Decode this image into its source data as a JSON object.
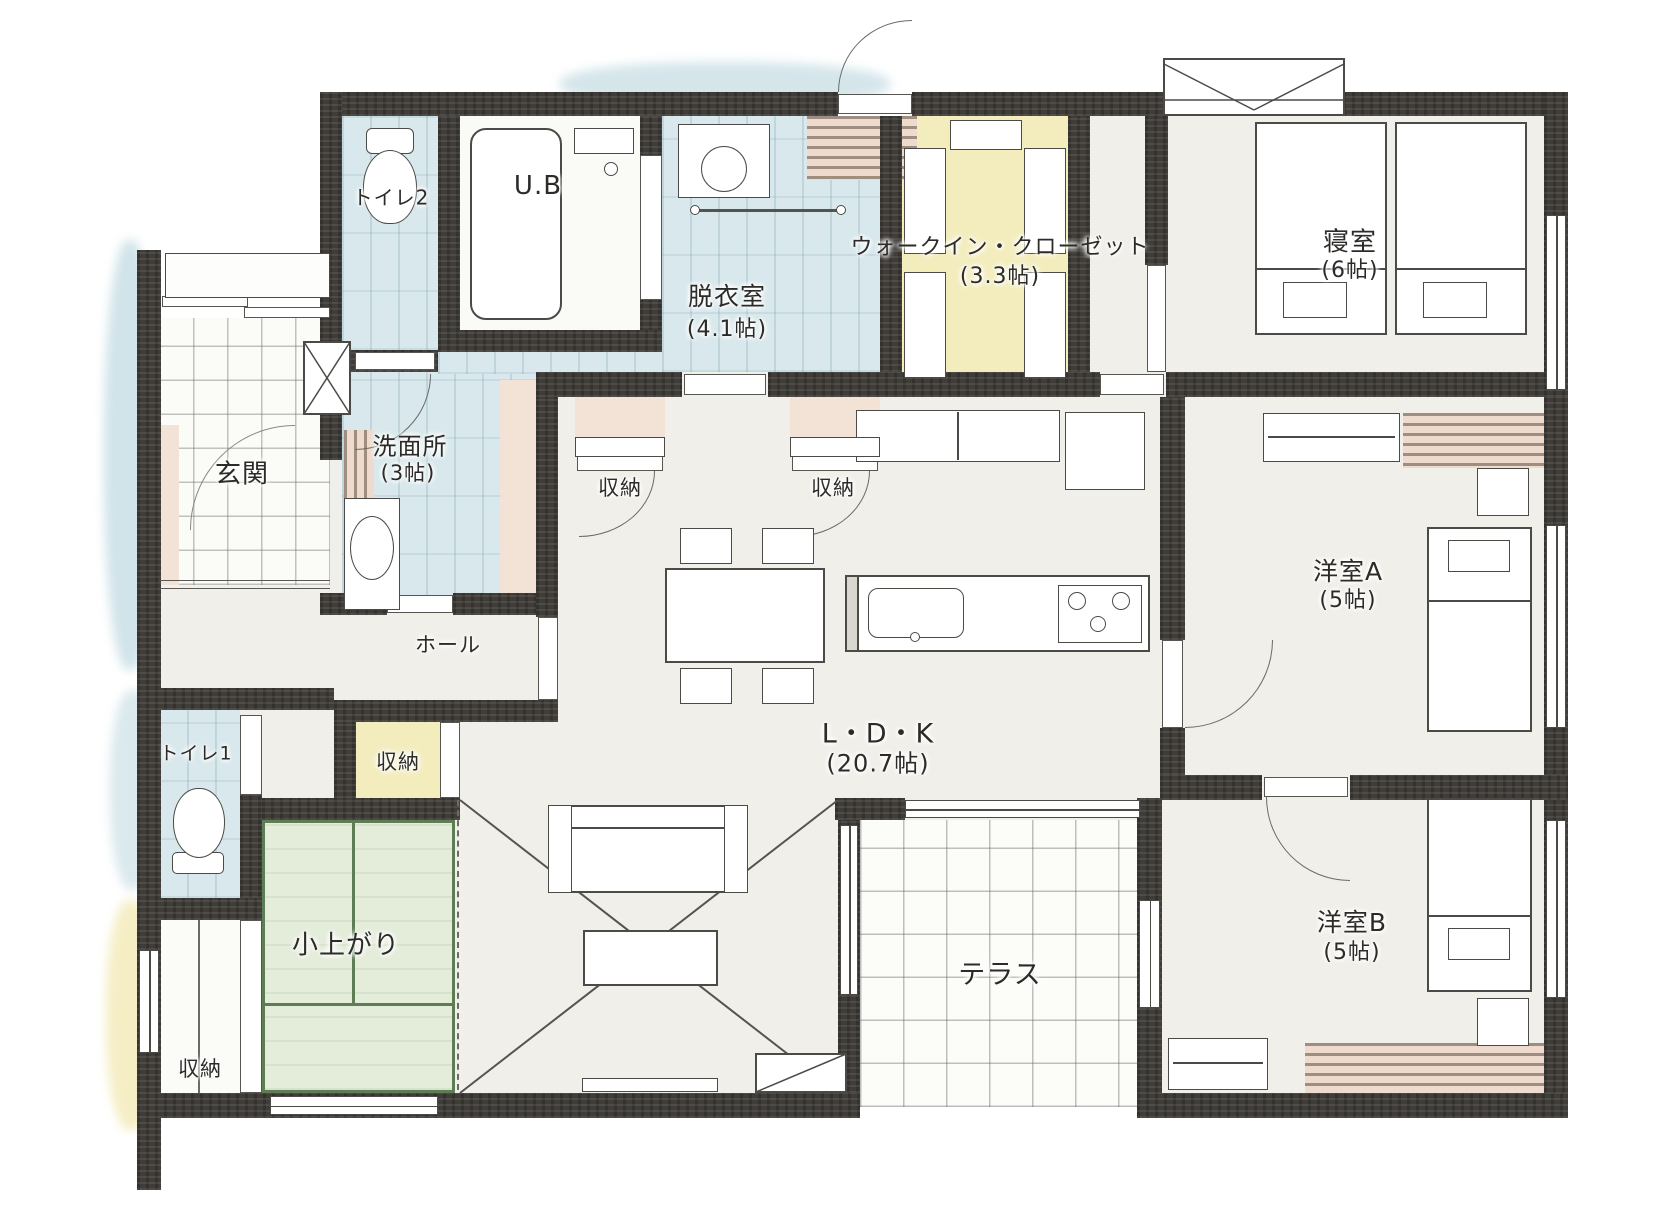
{
  "plan_title": "1LDK+和室コーナー平屋間取り図",
  "rooms": {
    "toilet2": {
      "label": "トイレ2"
    },
    "unit_bath": {
      "label": "U.B"
    },
    "dressing_room": {
      "label": "脱衣室",
      "size": "(4.1帖)"
    },
    "walk_in_closet": {
      "label": "ウォークイン・クローゼット",
      "size": "(3.3帖)"
    },
    "master_bedroom": {
      "label": "寝室",
      "size": "(6帖)"
    },
    "entrance": {
      "label": "玄関"
    },
    "washroom": {
      "label": "洗面所",
      "size": "(3帖)"
    },
    "pantry_a": {
      "label": "収納"
    },
    "pantry_b": {
      "label": "収納"
    },
    "hall": {
      "label": "ホール"
    },
    "ldk": {
      "label": "L・D・K",
      "size": "(20.7帖)"
    },
    "western_room_a": {
      "label": "洋室A",
      "size": "(5帖)"
    },
    "toilet1": {
      "label": "トイレ1"
    },
    "tatami_corner": {
      "label": "小上がり"
    },
    "tatami_storage": {
      "label": "収納"
    },
    "storage_west": {
      "label": "収納"
    },
    "terrace": {
      "label": "テラス"
    },
    "western_room_b": {
      "label": "洋室B",
      "size": "(5帖)"
    }
  },
  "palette": {
    "wall": "#403d39",
    "tile_blue": "#d8e8ec",
    "tatami_green": "#e4ecda",
    "tatami_border": "#5f7d55",
    "wood_beige": "#eedbcd",
    "closet_yellow": "#f3edbe",
    "accent_pink": "#f3e3d7",
    "floor_base": "#f1efe9"
  }
}
